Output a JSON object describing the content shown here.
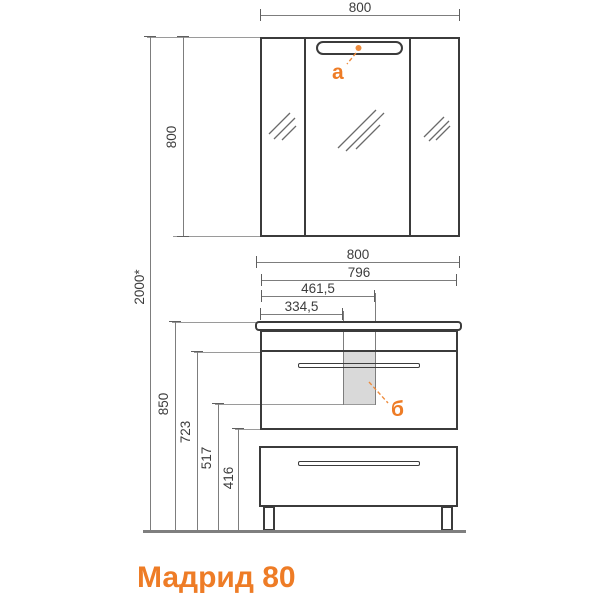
{
  "title": "Мадрид 80",
  "labels": {
    "light": "а",
    "siphon": "б"
  },
  "dimensions": {
    "mirror_width": "800",
    "mirror_height": "800",
    "total_height": "2000*",
    "vanity_width": "800",
    "vanity_body_width": "796",
    "sink_offset_right": "461,5",
    "sink_offset_left": "334,5",
    "vanity_height": "850",
    "counter_bottom_to_floor": "723",
    "siphon_bottom_to_floor": "517",
    "drawer_bottom_to_floor": "416"
  },
  "colors": {
    "accent": "#EE7C26",
    "object_line": "#3B3B3B",
    "dimension_line": "#7D7D7D",
    "extension_line": "#9A9A9A",
    "siphon_fill": "#D9D9D9",
    "floor_line": "#7F7F7F"
  }
}
